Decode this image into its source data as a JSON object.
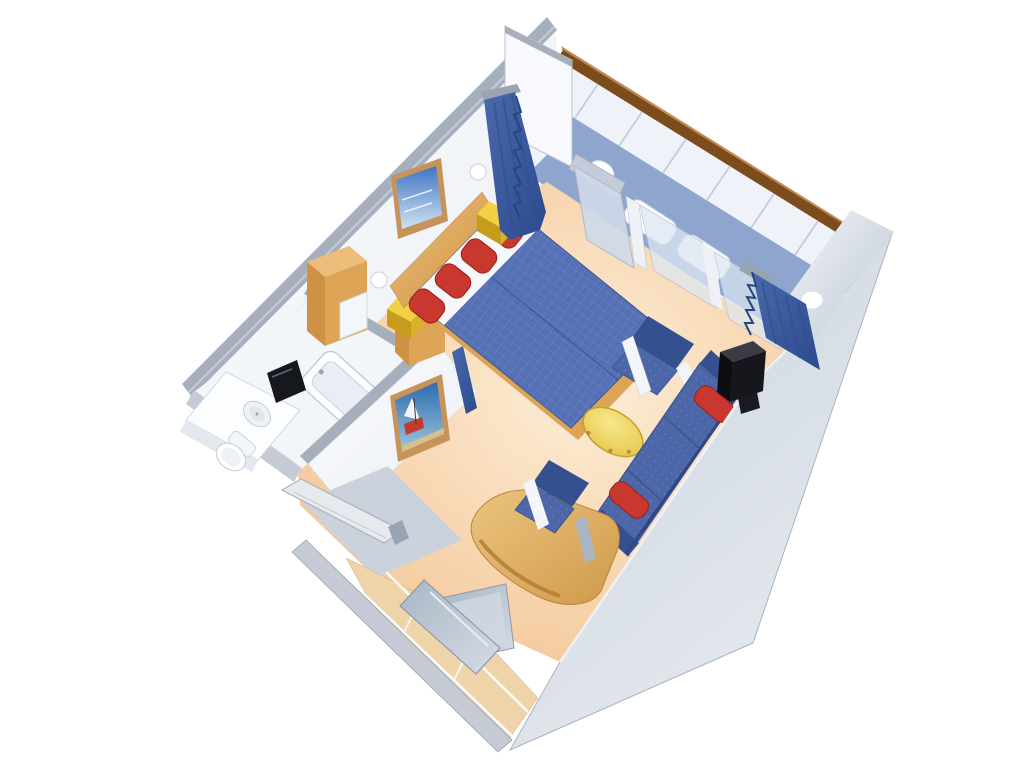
{
  "scene": {
    "name": "cruise-ship-stateroom-3d-cutaway-floor-plan",
    "view": "isometric-cutaway-from-above",
    "background": "#ffffff",
    "rooms": [
      {
        "name": "bedroom",
        "items": [
          "twin-bed",
          "twin-bed",
          "red-pillow",
          "red-pillow",
          "red-pillow",
          "red-pillow",
          "wood-headboard",
          "framed-seascape-picture",
          "wall-sconce",
          "wall-sconce",
          "yellow-nightstand-cube",
          "yellow-nightstand-cube",
          "wood-cabinet",
          "wood-cabinet",
          "divider-curtain"
        ],
        "colors": {
          "bedspread": "#5570b4",
          "pillows": "#c9382f"
        }
      },
      {
        "name": "sitting-area",
        "items": [
          "blue-sofa",
          "red-bolster",
          "red-bolster",
          "armchair",
          "desk-chair",
          "oval-coffee-table",
          "television",
          "window-curtain",
          "curved-wood-desk",
          "desk-mirror"
        ],
        "colors": {
          "sofa": "#4c66a8",
          "table": "#f0dc6e"
        }
      },
      {
        "name": "bathroom",
        "items": [
          "bathtub",
          "vanity-counter",
          "round-sink",
          "toilet",
          "black-mirror",
          "sailboat-painting"
        ],
        "colors": {
          "fixtures": "#fcfdfe"
        }
      },
      {
        "name": "entry",
        "items": [
          "entry-door-open",
          "wardrobe-with-shelves",
          "mirrored-closet-door"
        ],
        "colors": {
          "floor": "#cbd2dc"
        }
      },
      {
        "name": "balcony",
        "items": [
          "wood-handrail",
          "railing",
          "deck-table",
          "deck-chair",
          "deck-chair",
          "sliding-glass-doors"
        ],
        "colors": {
          "deck": "#8ea6cd",
          "handrail": "#7c4c1d"
        }
      }
    ]
  },
  "colors": {
    "floor_light": "#fdeed8",
    "floor_deep": "#f2c18e",
    "wall_white": "#fdfdfe",
    "wall_shadow": "#e8edf3",
    "cut_band": "#a6b0bd",
    "cut_band_light": "#c4cbd5",
    "ext_wall": "#cdd5df",
    "ext_wall_light": "#e7ebf0",
    "right_wall_light": "#f3f6fa",
    "balcony_floor": "#8ea6cd",
    "railing_face": "#eff3f9",
    "railing_rib": "#c3cfdf",
    "handrail": "#7c4c1d",
    "handrail_light": "#c08a50",
    "glass": "#cfdaea",
    "glass_light": "#dde7f3",
    "frame_white": "#eef1f6",
    "curtain_dark": "#2c4a8d",
    "curtain_light": "#4a69ad",
    "bed_blue": "#5570b4",
    "bed_grid": "#7288c5",
    "bed_dark": "#3d568f",
    "sheet_white": "#f6f8fb",
    "pillow_red": "#c9382f",
    "pillow_red_dark": "#992018",
    "wood": "#cf9244",
    "wood_light": "#ecbe7a",
    "wood_mid": "#dda455",
    "nightstand_yellow": "#f2d145",
    "nightstand_side": "#d9b02a",
    "nightstand_front": "#c79b1c",
    "table_yellow": "#f0dc6e",
    "table_rim": "#c2a12e",
    "sofa_blue": "#4c66a8",
    "sofa_dot": "#6880bd",
    "sofa_dark": "#35508f",
    "tv_black": "#16171d",
    "tv_top": "#3a3b45",
    "bath_white": "#f3f6f9",
    "fixture_white": "#fcfdfe",
    "fixture_line": "#c3cdd9",
    "mirror_black": "#17181e",
    "entry_floor": "#cbd2dc",
    "closet_tan": "#efd4a9",
    "mirror_gray": "#aab6c6",
    "mirror_gray_light": "#d4dce4",
    "painting_sea": "#3f74c4",
    "painting_sky": "#cfe3f2",
    "painting2_sea": "#2f6cae",
    "painting2_sand": "#d8c08a",
    "painting2_red": "#c23b2e",
    "frame_tan": "#c6935a"
  }
}
